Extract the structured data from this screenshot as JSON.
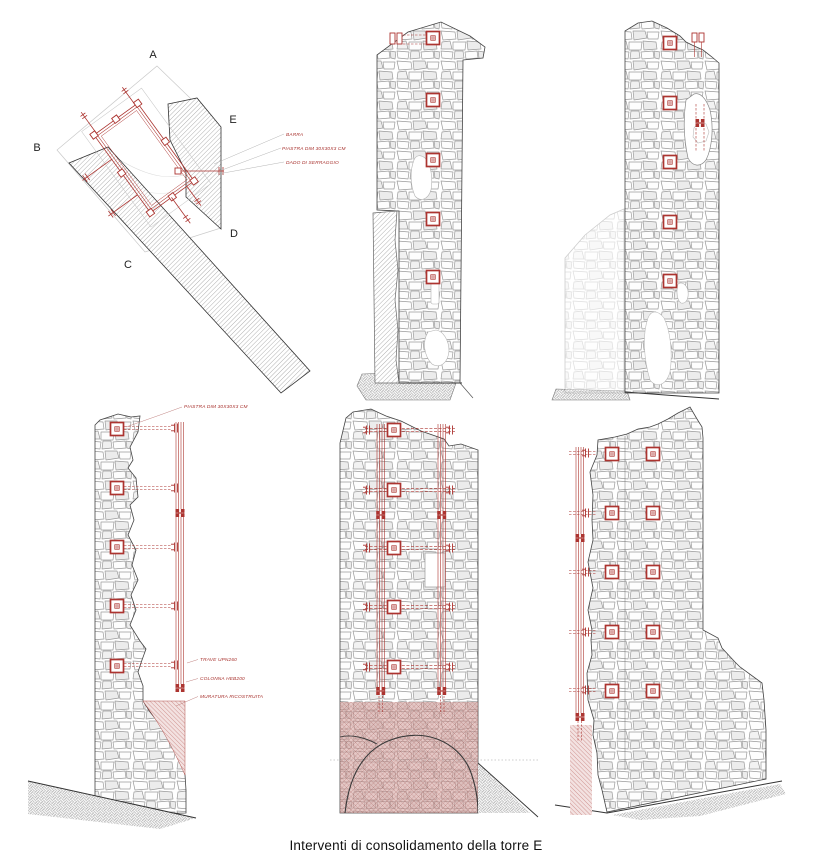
{
  "caption": "Interventi di consolidamento della torre E",
  "colors": {
    "red": "#ac3430",
    "pink_hatch": "#cf9a97",
    "stone_line": "#9a9a9a",
    "outline": "#444444"
  },
  "plan": {
    "corners": {
      "a": "A",
      "b": "B",
      "c": "C",
      "d": "D",
      "e": "E"
    },
    "annotations": {
      "barra": "BARRA",
      "piastra": "PIASTRA DIM 30X30X3 CM",
      "dado": "DADO DI SERRAGGIO"
    }
  },
  "side_elevation": {
    "annotations": {
      "piastra": "PIASTRA DIM 30X30X3 CM",
      "trave": "TRAVE UPN260",
      "colonna": "COLONNA HEB200",
      "muratura": "MURATURA RICOSTRUITA"
    }
  }
}
